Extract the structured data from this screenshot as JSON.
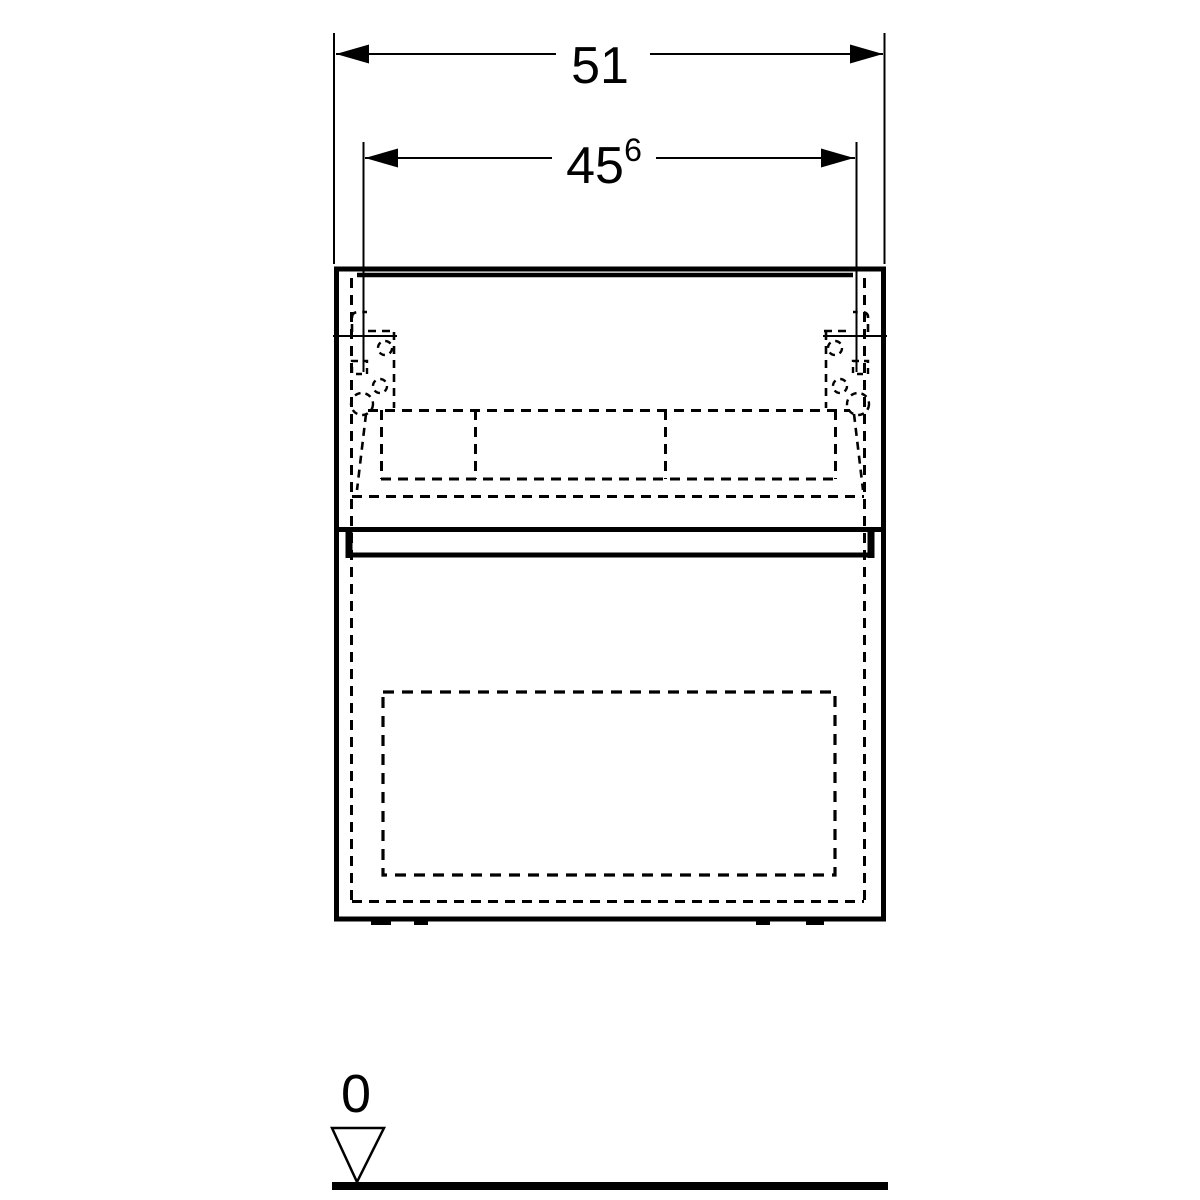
{
  "page": {
    "background_color": "#ffffff",
    "line_color": "#000000",
    "description": "technical-dimension-drawing-front-view-vanity-cabinet"
  },
  "drawing": {
    "dimension_total_width": {
      "label": "51"
    },
    "dimension_fixing_width": {
      "label": "45",
      "superscript": "6"
    },
    "datum_level": {
      "label": "0"
    }
  }
}
